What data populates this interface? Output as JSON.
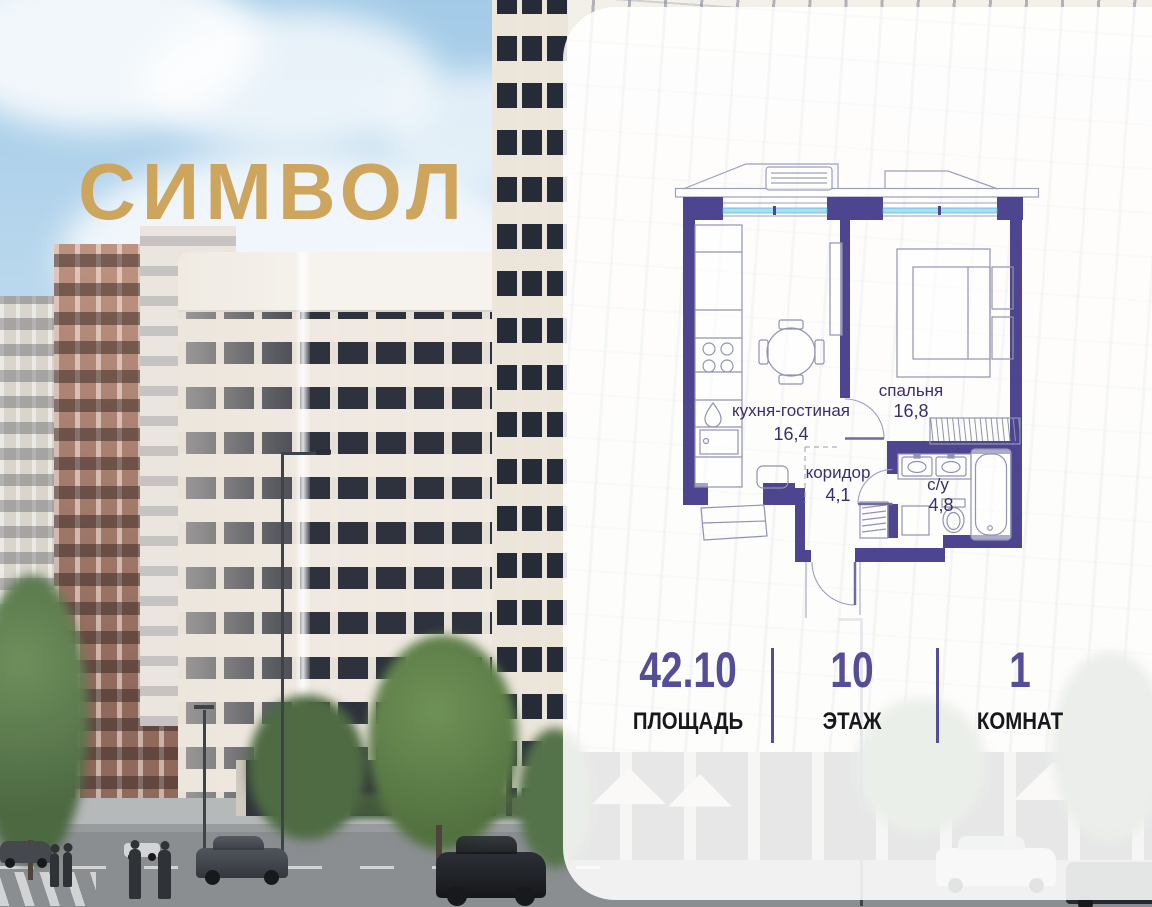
{
  "logo": {
    "text": "СИМВОЛ",
    "color": "#CDA55C"
  },
  "floor_plan": {
    "wall_color": "#4E4590",
    "window_glass_color": "#AADEF2",
    "label_color": "#3B2F6B",
    "rooms": [
      {
        "id": "kitchen-living",
        "name": "кухня-гостиная",
        "area": "16,4"
      },
      {
        "id": "bedroom",
        "name": "спальня",
        "area": "16,8"
      },
      {
        "id": "corridor",
        "name": "коридор",
        "area": "4,1"
      },
      {
        "id": "bathroom",
        "name": "с/у",
        "area": "4,8"
      }
    ]
  },
  "stats": {
    "accent_color": "#544D98",
    "items": [
      {
        "value": "42.10",
        "label": "ПЛОЩАДЬ"
      },
      {
        "value": "10",
        "label": "ЭТАЖ"
      },
      {
        "value": "1",
        "label": "КОМНАТ"
      }
    ]
  }
}
